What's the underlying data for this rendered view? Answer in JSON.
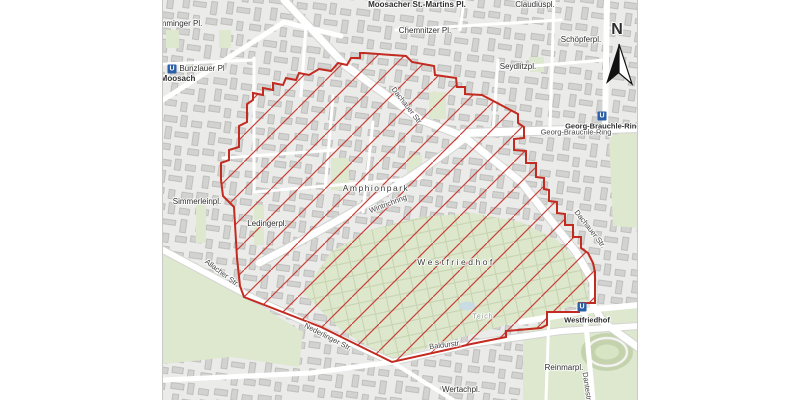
{
  "map": {
    "labels": [
      {
        "id": "moosacher-st-martins-pl",
        "text": "Moosacher St.-Martins Pl.",
        "x": 416,
        "y": 5,
        "bold": true,
        "size": 8
      },
      {
        "id": "claudiuspl",
        "text": "Claudiuspl.",
        "x": 534,
        "y": 5,
        "size": 8
      },
      {
        "id": "chemnitzer-pl",
        "text": "Chemnitzer Pl.",
        "x": 424,
        "y": 31,
        "size": 8
      },
      {
        "id": "schoepferpl",
        "text": "Schöpferpl.",
        "x": 580,
        "y": 40,
        "size": 8
      },
      {
        "id": "seydlitzpl",
        "text": "Seydlitzpl.",
        "x": 517,
        "y": 67,
        "size": 8
      },
      {
        "id": "memminger-pl",
        "text": "mminger Pl.",
        "x": 180,
        "y": 24,
        "size": 8
      },
      {
        "id": "moosach",
        "text": "Moosach",
        "x": 177,
        "y": 79,
        "bold": true,
        "size": 8
      },
      {
        "id": "dachauer-str-north",
        "text": "Dachauer Str.",
        "x": 406,
        "y": 106,
        "rot": 52,
        "size": 7.5,
        "color": "#454545"
      },
      {
        "id": "georg-brauchle-ring-street",
        "text": "Georg-Brauchle-Ring",
        "x": 575,
        "y": 132,
        "size": 7.5,
        "color": "#454545"
      },
      {
        "id": "amphionpark",
        "text": "Amphionpark",
        "x": 375,
        "y": 188,
        "ls": 1.5,
        "size": 8.5,
        "color": "#3a3a3a"
      },
      {
        "id": "wintrichring",
        "text": "Wintrichring",
        "x": 387,
        "y": 204,
        "rot": -21,
        "size": 7.5,
        "color": "#454545"
      },
      {
        "id": "simmerleinpl",
        "text": "Simmerleinpl.",
        "x": 196,
        "y": 202,
        "size": 8
      },
      {
        "id": "ledingerpl",
        "text": "Ledingerpl.",
        "x": 266,
        "y": 224,
        "size": 8
      },
      {
        "id": "allacher-str",
        "text": "Allacher Str.",
        "x": 221,
        "y": 273,
        "rot": 37,
        "size": 7.5,
        "color": "#454545"
      },
      {
        "id": "westfriedhof-cemetery",
        "text": "Westfriedhof",
        "x": 455,
        "y": 262,
        "ls": 2.5,
        "size": 8.5,
        "color": "#3a3a3a"
      },
      {
        "id": "teich",
        "text": "Teich",
        "x": 482,
        "y": 317,
        "size": 7,
        "ls": 1,
        "color": "#8f9c90"
      },
      {
        "id": "nederlinger-str",
        "text": "Nederlinger Str.",
        "x": 327,
        "y": 337,
        "rot": 27,
        "size": 7.5,
        "color": "#454545"
      },
      {
        "id": "baldurstr",
        "text": "Baldurstr.",
        "x": 444,
        "y": 345,
        "rot": -7,
        "size": 7.5,
        "color": "#454545"
      },
      {
        "id": "wertachpl",
        "text": "Wertachpl.",
        "x": 460,
        "y": 390,
        "size": 8
      },
      {
        "id": "reinmarpl",
        "text": "Reinmarpl.",
        "x": 563,
        "y": 368,
        "size": 8
      },
      {
        "id": "dantestr",
        "text": "Dantestr.",
        "x": 586,
        "y": 387,
        "rot": 82,
        "size": 7.5,
        "color": "#454545"
      },
      {
        "id": "dachauer-str-south",
        "text": "Dachauer Str.",
        "x": 589,
        "y": 229,
        "rot": 52,
        "size": 7.5,
        "color": "#454545"
      }
    ],
    "stations": [
      {
        "id": "bunzlauer-pl",
        "icon": "U",
        "label": "Bunzlauer Pl",
        "icon_x": 171,
        "icon_y": 69,
        "label_x": 201,
        "label_y": 69,
        "bold": false
      },
      {
        "id": "georg-brauchle-ring",
        "icon": "U",
        "label": "Georg-Brauchle-Ring",
        "icon_x": 601,
        "icon_y": 116,
        "label_x": 602,
        "label_y": 126,
        "bold": true
      },
      {
        "id": "westfriedhof",
        "icon": "U",
        "label": "Westfriedhof",
        "icon_x": 581,
        "icon_y": 307,
        "label_x": 586,
        "label_y": 320,
        "bold": true
      }
    ]
  },
  "compass": {
    "label": "N"
  },
  "colors": {
    "map_background": "#ebebe9",
    "street": "#ffffff",
    "park_green": "#dde8cf",
    "cemetery_green": "#dce7cb",
    "building_gray": "#d2d2d0",
    "zone_red": "#c32b20",
    "ubahn_blue": "#2a5fa8",
    "water_blue": "#c9dce4"
  },
  "overlay": {
    "id": "restricted-zone",
    "style": "red diagonal hatch with red outline"
  }
}
